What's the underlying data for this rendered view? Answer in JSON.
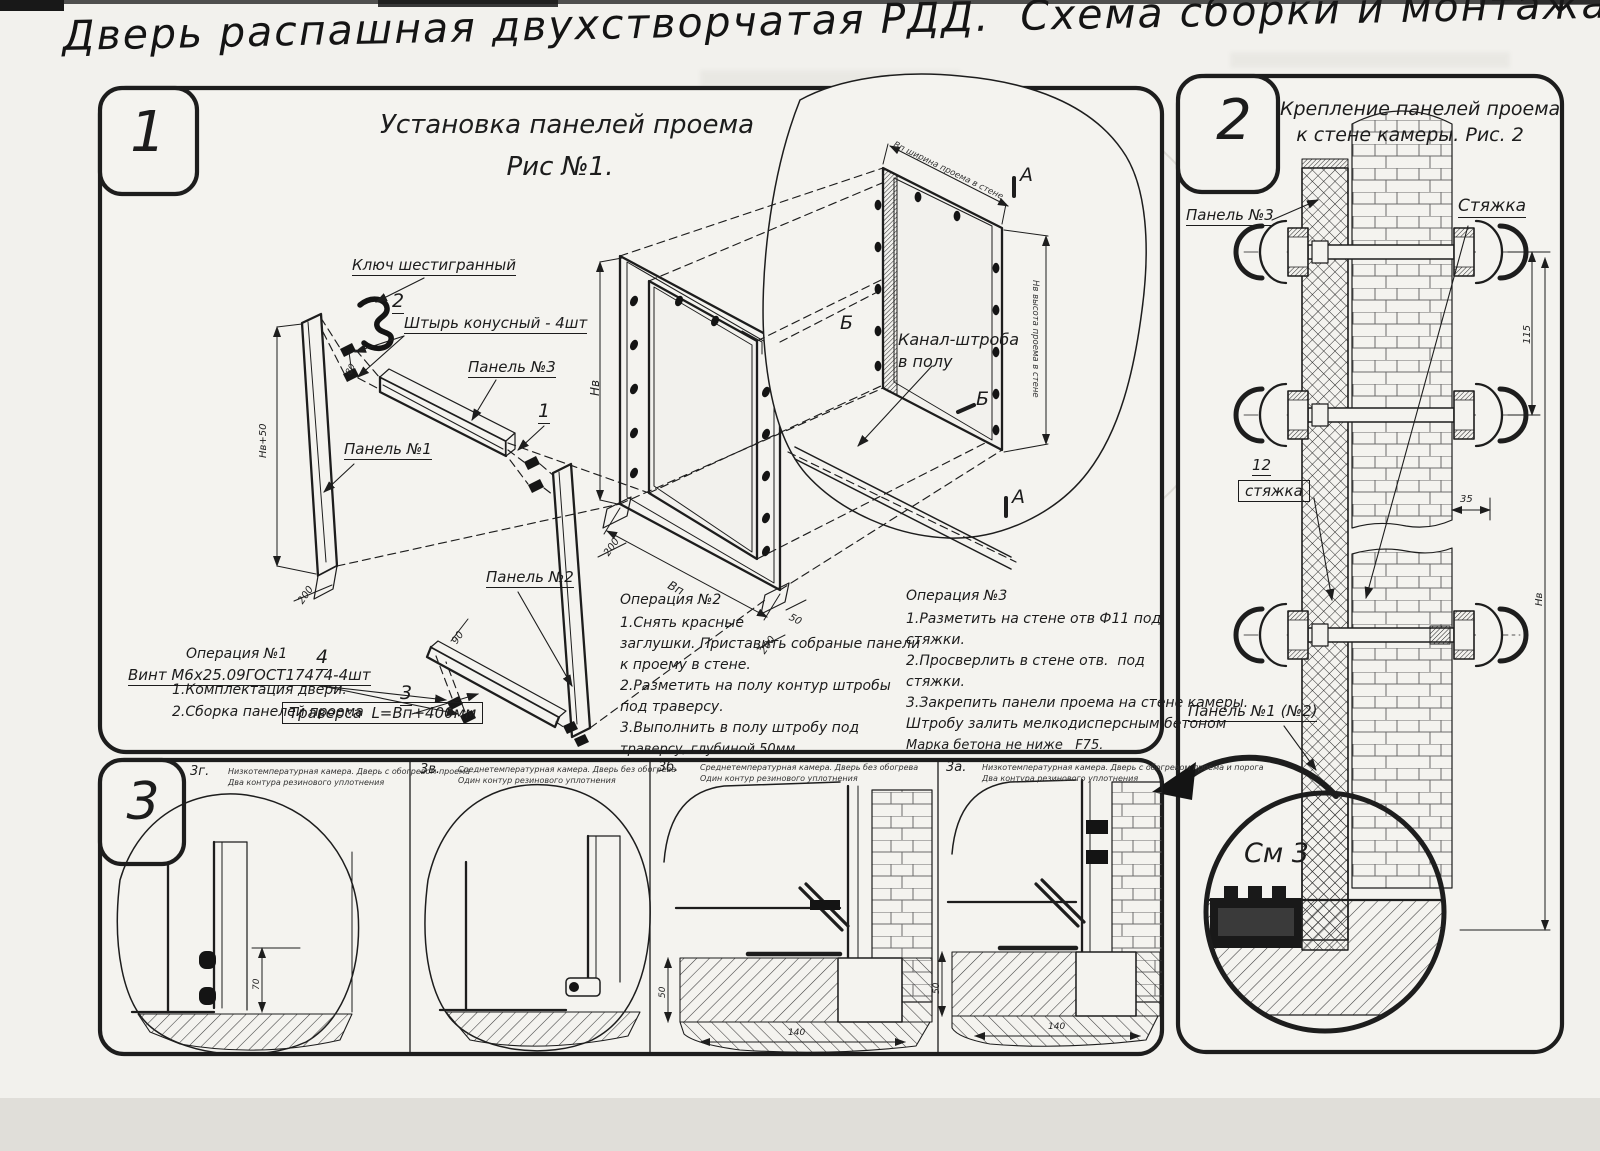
{
  "title": "Дверь распашная двухстворчатая РДД.  Схема сборки и монтажа №2",
  "s1": {
    "badge": "1",
    "t1": "Установка панелей проема",
    "t2": "Рис №1.",
    "lbl": {
      "key": "Ключ шестигранный",
      "n2": "2",
      "pin": "Штырь конусный - 4шт",
      "p3": "Панель №3",
      "n1": "1",
      "p1": "Панель №1",
      "p2": "Панель №2",
      "n4": "4",
      "screw": "Винт М6х25.09ГОСТ17474-4шт",
      "n3": "3",
      "trav": "Траверса  L=Вп+400мм",
      "ch1": "Канал-штроба",
      "ch2": "в полу",
      "A": "А",
      "B": "Б"
    },
    "dim": {
      "hv50": "Нв+50",
      "d200": "200",
      "d80": "80",
      "d90": "90",
      "hv": "Нв",
      "vp": "Вп",
      "d50": "50",
      "ww": "Вп ширина проема в стене",
      "wh": "Нв высота проема в стене"
    },
    "op1": {
      "h": "Операция №1",
      "l": [
        "1.Комплектация двери.",
        "2.Сборка панелей проема"
      ]
    },
    "op2": {
      "h": "Операция №2",
      "l": [
        "1.Снять красные",
        "заглушки. Приставить собраные панели",
        "к проему в стене.",
        "2.Разметить на полу контур штробы",
        "под траверсу.",
        "3.Выполнить в полу штробу под",
        "траверсу, глубиной 50мм"
      ]
    },
    "op3": {
      "h": "Операция №3",
      "l": [
        "1.Разметить на стене отв Ф11 под",
        "стяжки.",
        "2.Просверлить в стене отв.  под",
        "стяжки.",
        "3.Закрепить панели проема на стене камеры.",
        "Штробу залить мелкодисперсным бетоном",
        "Марка бетона не ниже   F75."
      ]
    }
  },
  "s2": {
    "badge": "2",
    "t1": "Крепление панелей проема",
    "t2": "к стене камеры. Рис. 2",
    "tie": "Стяжка",
    "p3": "Панель №3",
    "n12": "12",
    "tie2": "стяжка",
    "p12": "Панель №1 (№2)",
    "see": "См 3",
    "d115": "115",
    "d35": "35",
    "hv": "Нв"
  },
  "s3": {
    "badge": "3",
    "cells": [
      {
        "id": "3г.",
        "c1": "Низкотемпературная камера. Дверь с обогревом проема",
        "c2": "Два контура резинового уплотнения",
        "d1": "70"
      },
      {
        "id": "3в.",
        "c1": "Среднетемпературная камера. Дверь без обогрева",
        "c2": "Один контур резинового уплотнения"
      },
      {
        "id": "3б.",
        "c1": "Среднетемпературная камера. Дверь без обогрева",
        "c2": "Один контур резинового уплотнения",
        "dv": "50",
        "dh": "140"
      },
      {
        "id": "3а.",
        "c1": "Низкотемпературная камера. Дверь с обогревом проема и порога",
        "c2": "Два контура резинового уплотнения",
        "dv": "50",
        "dh": "140"
      }
    ]
  }
}
